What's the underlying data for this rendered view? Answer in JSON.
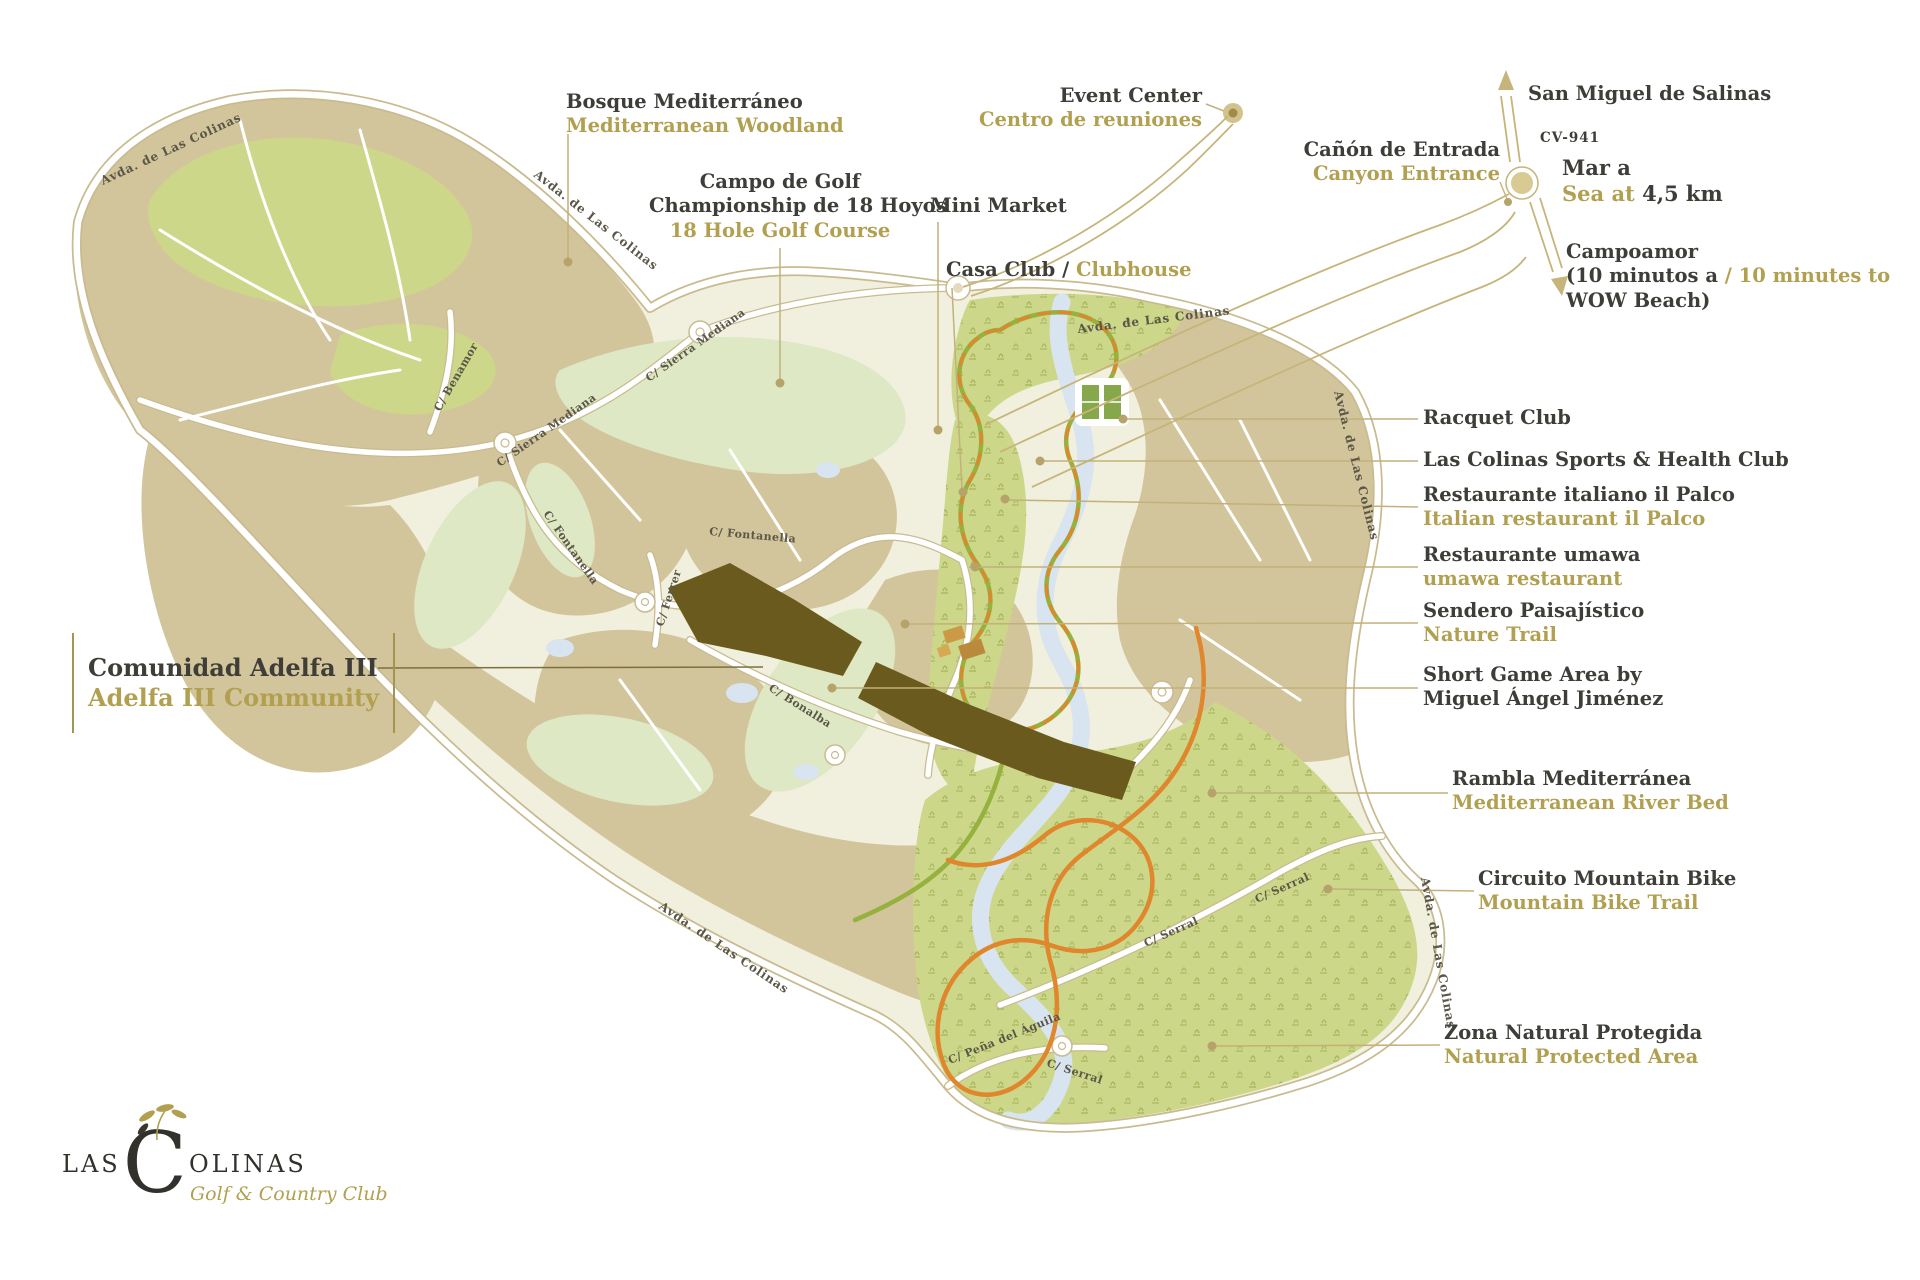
{
  "colors": {
    "gold_text": "#b2a051",
    "dark_text": "#3e3d38",
    "beige": "#d3c59b",
    "pale_base": "#f1f0de",
    "bright_green": "#cdd78a",
    "river_blue": "#d8e4ef",
    "adelfa_brown": "#6b5a1d",
    "trail_orange": "#e0862c",
    "trail_green": "#96b13d",
    "road_gold": "#c6b47a"
  },
  "logo": {
    "word_start": "LAS",
    "initial": "C",
    "word_end": "OLINAS",
    "tagline": "Golf & Country Club"
  },
  "callouts": {
    "bosque": {
      "es": "Bosque Mediterráneo",
      "en": "Mediterranean Woodland"
    },
    "campo_golf": {
      "es1": "Campo de Golf",
      "es2": "Championship de 18 Hoyos",
      "en": "18 Hole Golf Course"
    },
    "mini_market": {
      "label": "Mini Market"
    },
    "casa_club": {
      "es": "Casa Club / ",
      "en": "Clubhouse"
    },
    "event_center": {
      "en": "Event Center",
      "es": "Centro de reuniones"
    },
    "canon_entrada": {
      "es": "Cañón de Entrada",
      "en": "Canyon Entrance"
    },
    "san_miguel": {
      "label": "San Miguel de Salinas"
    },
    "cv941": {
      "label": "CV-941"
    },
    "mar": {
      "es": "Mar a",
      "en": "Sea at",
      "dist": " 4,5 km"
    },
    "campoamor": {
      "l1": "Campoamor",
      "l2a": "(10 minutos a ",
      "l2b": "/ 10 minutes to",
      "l3": "WOW Beach)"
    },
    "racquet": {
      "label": "Racquet Club"
    },
    "sports_club": {
      "label": "Las Colinas Sports & Health Club"
    },
    "il_palco": {
      "es": "Restaurante italiano il Palco",
      "en": "Italian restaurant il Palco"
    },
    "umawa": {
      "es": "Restaurante umawa",
      "en": "umawa restaurant"
    },
    "sendero": {
      "es": "Sendero Paisajístico",
      "en": "Nature Trail"
    },
    "short_game": {
      "l1": "Short Game Area by",
      "l2": "Miguel Ángel Jiménez"
    },
    "rambla": {
      "es": "Rambla Mediterránea",
      "en": "Mediterranean River Bed"
    },
    "mtb": {
      "es": "Circuito Mountain Bike",
      "en": "Mountain Bike Trail"
    },
    "zona_natural": {
      "es": "Zona Natural Protegida",
      "en": "Natural Protected Area"
    },
    "adelfa": {
      "es": "Comunidad Adelfa III",
      "en": "Adelfa III Community"
    }
  },
  "streets": {
    "avda": "Avda. de Las Colinas",
    "sierra_mediana": "C/ Sierra Mediana",
    "fontanella": "C/ Fontanella",
    "benamor": "C/ Benamor",
    "ferrer": "C/ Ferrer",
    "bonalba": "C/ Bonalba",
    "serral": "C/ Serral",
    "pena_aguila": "C/ Peña del Águila"
  }
}
